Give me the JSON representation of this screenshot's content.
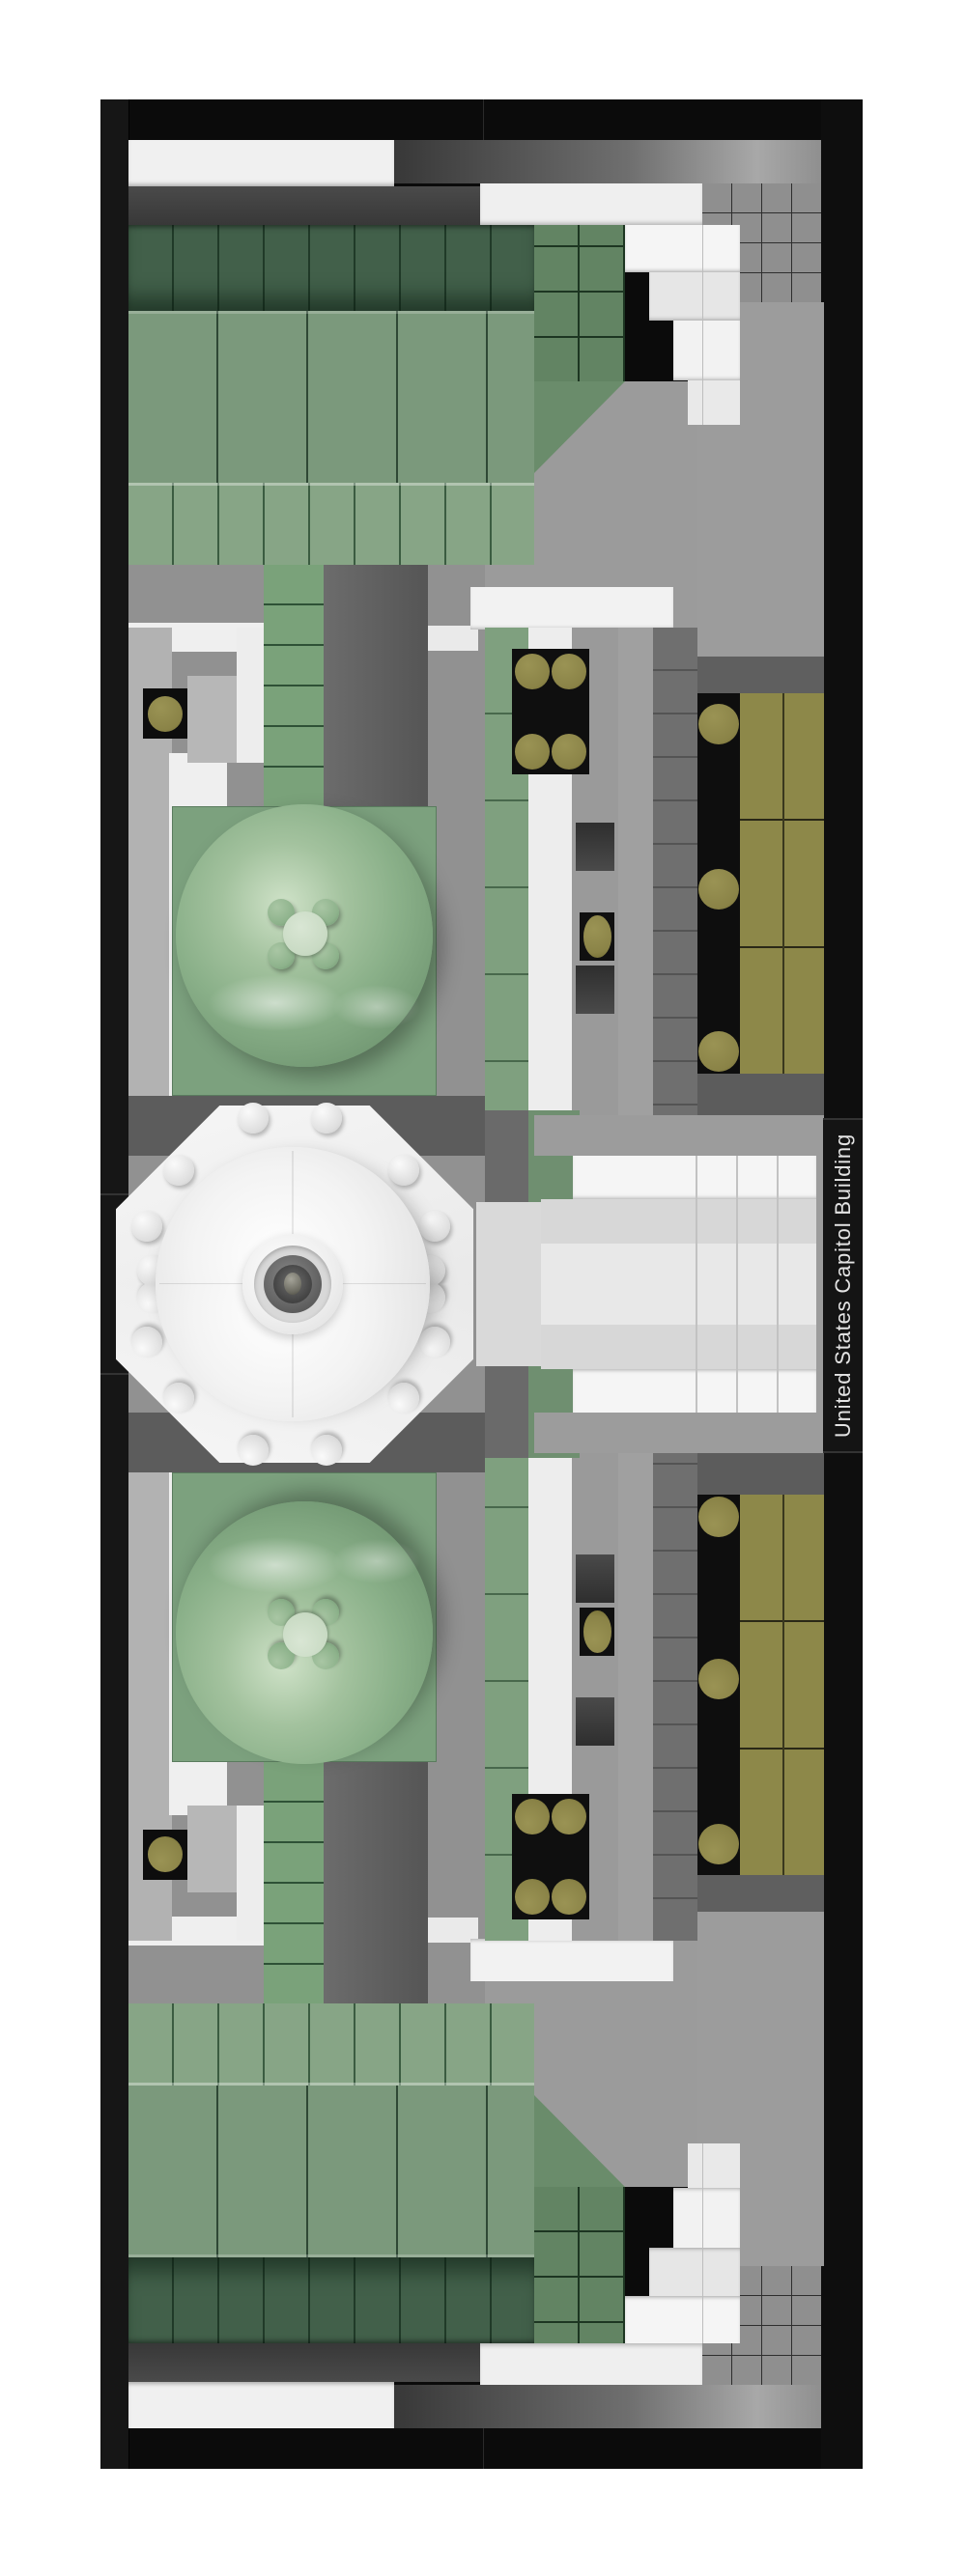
{
  "label": {
    "text": "United States Capitol Building"
  },
  "palette": {
    "page_background": "#ffffff",
    "base_black": "#0b0b0b",
    "base_wall_highlight": "#161616",
    "roof_green_dark": "#42604a",
    "roof_green_mid": "#7b997c",
    "roof_green_light": "#87a586",
    "roof_seam_green": "#2f4835",
    "ridge_green": "#7aa27a",
    "chamber_dome_green": "#8ab089",
    "chamber_dome_highlight": "#cfe2c8",
    "dome_pad_green": "#7ca17e",
    "sand_green_tile": "#7fa07f",
    "olive_tan": "#8d8849",
    "olive_stud": "#8a8347",
    "white_tile": "#f2f2f2",
    "bright_white_tile": "#f5f5f5",
    "light_gray_tile": "#d7d7d7",
    "plaza_gray": "#9b9b9b",
    "mid_gray": "#919191",
    "dark_gray_roof": "#5f5f5f",
    "window_recess_gray": "#3d3d3d",
    "rotunda_dome_white": "#f3f3f3",
    "label_background": "#141414",
    "label_text_color": "#e3e3e3"
  }
}
